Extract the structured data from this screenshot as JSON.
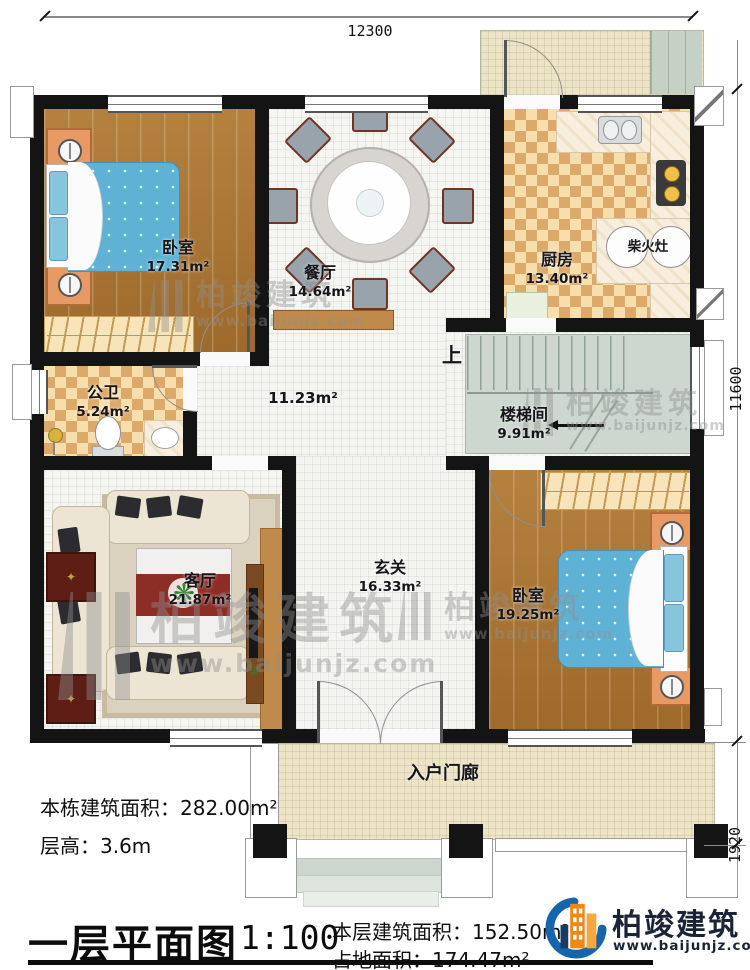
{
  "plan": {
    "dimensions": {
      "width": "12300",
      "height_main": "11600",
      "height_porch": "1920"
    },
    "rooms": {
      "bedroom1": {
        "name": "卧室",
        "area": "17.31m²"
      },
      "dining": {
        "name": "餐厅",
        "area": "14.64m²"
      },
      "kitchen": {
        "name": "厨房",
        "area": "13.40m²"
      },
      "firewood_stove": {
        "name": "柴火灶"
      },
      "bathroom": {
        "name": "公卫",
        "area": "5.24m²"
      },
      "hall": {
        "area": "11.23m²"
      },
      "stairwell": {
        "name": "楼梯间",
        "area": "9.91m²",
        "up_label": "上"
      },
      "living": {
        "name": "客厅",
        "area": "21.87m²"
      },
      "foyer": {
        "name": "玄关",
        "area": "16.33m²"
      },
      "bedroom2": {
        "name": "卧室",
        "area": "19.25m²"
      },
      "entry_porch": {
        "name": "入户门廊"
      }
    },
    "notes": {
      "building_area_label": "本栋建筑面积：",
      "building_area_value": "282.00m²",
      "floor_height_label": "层高：",
      "floor_height_value": "3.6m"
    }
  },
  "titleblock": {
    "title": "一层平面图",
    "scale": "1:100",
    "floor_area_label": "本层建筑面积：",
    "floor_area_value": "152.50m²",
    "land_area_label": "占地面积：",
    "land_area_value": "174.47m²"
  },
  "brand": {
    "name": "柏竣建筑",
    "url": "www.baijunjz.com"
  },
  "watermark": {
    "name": "柏竣建筑",
    "url": "www.baijunjz.com"
  },
  "colors": {
    "wall": "#141414",
    "wood": "#ab763a",
    "tile": "#f4f4f1",
    "checker": "#f6dfad",
    "checker_alt": "#dca96a",
    "porch": "#ece4c4",
    "stair": "#cdd7cf",
    "bed": "#66b5d6",
    "accent_orange": "#f08818",
    "accent_blue": "#1565ad"
  }
}
